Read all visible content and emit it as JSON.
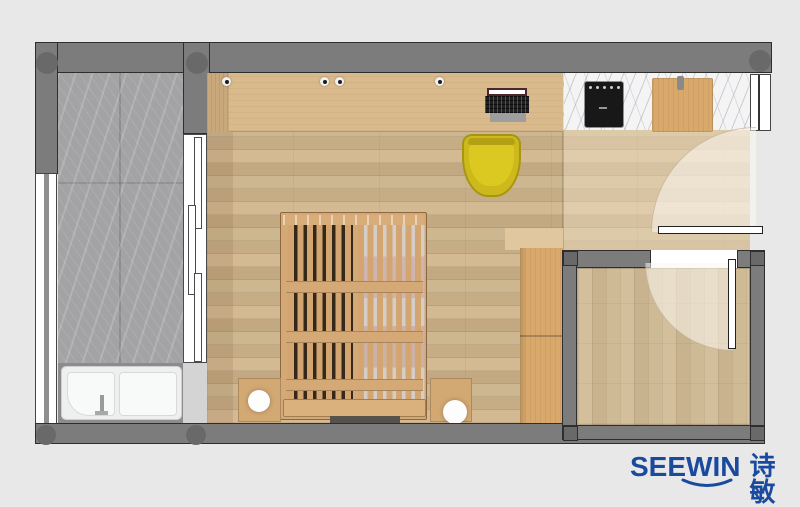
{
  "brand": {
    "name_en": "SEEWIN",
    "name_cn": "诗敏",
    "color": "#1a4a9e"
  },
  "palette": {
    "background": "#e8e8e8",
    "wall": "#7c7c7c",
    "wall_outline": "#2e2e2e",
    "column": "#696969",
    "marble_gray": "#a3a3a6",
    "marble_white": "#f4f4f5",
    "wood_desk": "#d9ba8c",
    "wood_floor": "#ccb28d",
    "wood_floor_entry": "#cdb793",
    "wood_bed": "#d5a976",
    "wood_wardrobe": "#d9a96c",
    "chair_yellow": "#cdb91c",
    "appliance_black": "#181818",
    "fixture_white": "#eef0f0",
    "door_swing": "rgba(252,247,240,0.55)",
    "brand_blue": "#1a4a9e"
  }
}
